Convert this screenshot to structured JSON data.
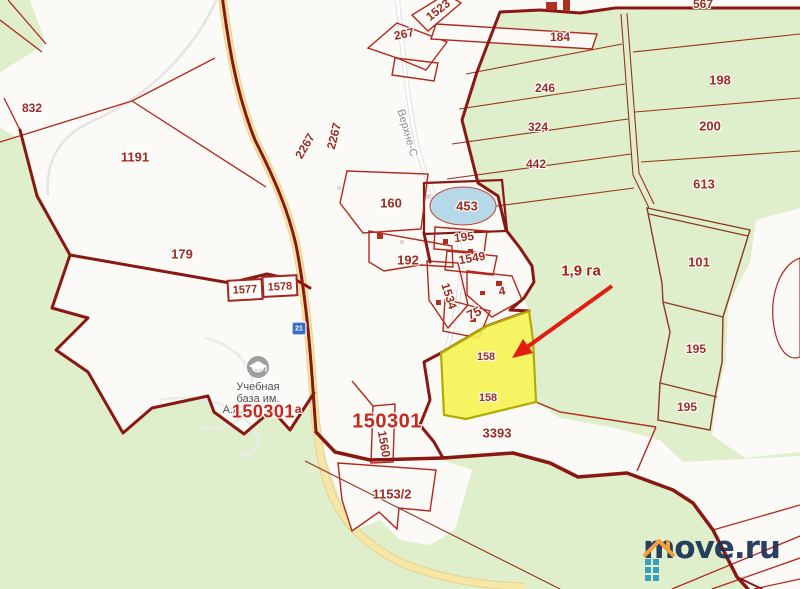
{
  "map": {
    "street_label": "Верхне-С",
    "poi_education": {
      "icon": "education-icon",
      "name_line1": "Учебная",
      "name_line2": "база им.",
      "name_line3": "А.А."
    },
    "road_sign_number": "21",
    "quarter_label_left": "150301ᵃ",
    "quarter_label_center": "150301",
    "highlight": {
      "area_label": "1,9 га",
      "number_top": "158",
      "number_bottom": "158"
    },
    "parcels": {
      "p832": "832",
      "p1191": "1191",
      "p179": "179",
      "p1523": "1523",
      "p267": "267",
      "p2267a": "2267",
      "p2267b": "2267",
      "p184": "184",
      "p567": "567",
      "p246": "246",
      "p198": "198",
      "p324": "324",
      "p200": "200",
      "p442": "442",
      "p613": "613",
      "p160": "160",
      "p453": "453",
      "p195_center": "195",
      "p1549": "1549",
      "p192": "192",
      "p1534": "1534",
      "p4": "4",
      "p75": "75",
      "p101": "101",
      "p195_right1": "195",
      "p195_right2": "195",
      "p1577": "1577",
      "p1578": "1578",
      "p1560": "1560",
      "p3393": "3393",
      "p1153_2": "1153/2"
    }
  },
  "watermark": {
    "brand": "move.ru"
  },
  "colors": {
    "forest_green": "#dfeecb",
    "pond_blue": "#b7d8e9",
    "highlight_fill": "#f5f24e",
    "highlight_border": "#b3ac00",
    "boundary_red": "#8a1712",
    "parcel_red": "#b3271d",
    "label_red": "#9e2b1f",
    "arrow_red": "#e21d12",
    "road_yellow": "#f6e7a6",
    "logo_navy": "#1b3158",
    "logo_teal": "#2d9cc0",
    "logo_orange": "#f49b2c"
  }
}
